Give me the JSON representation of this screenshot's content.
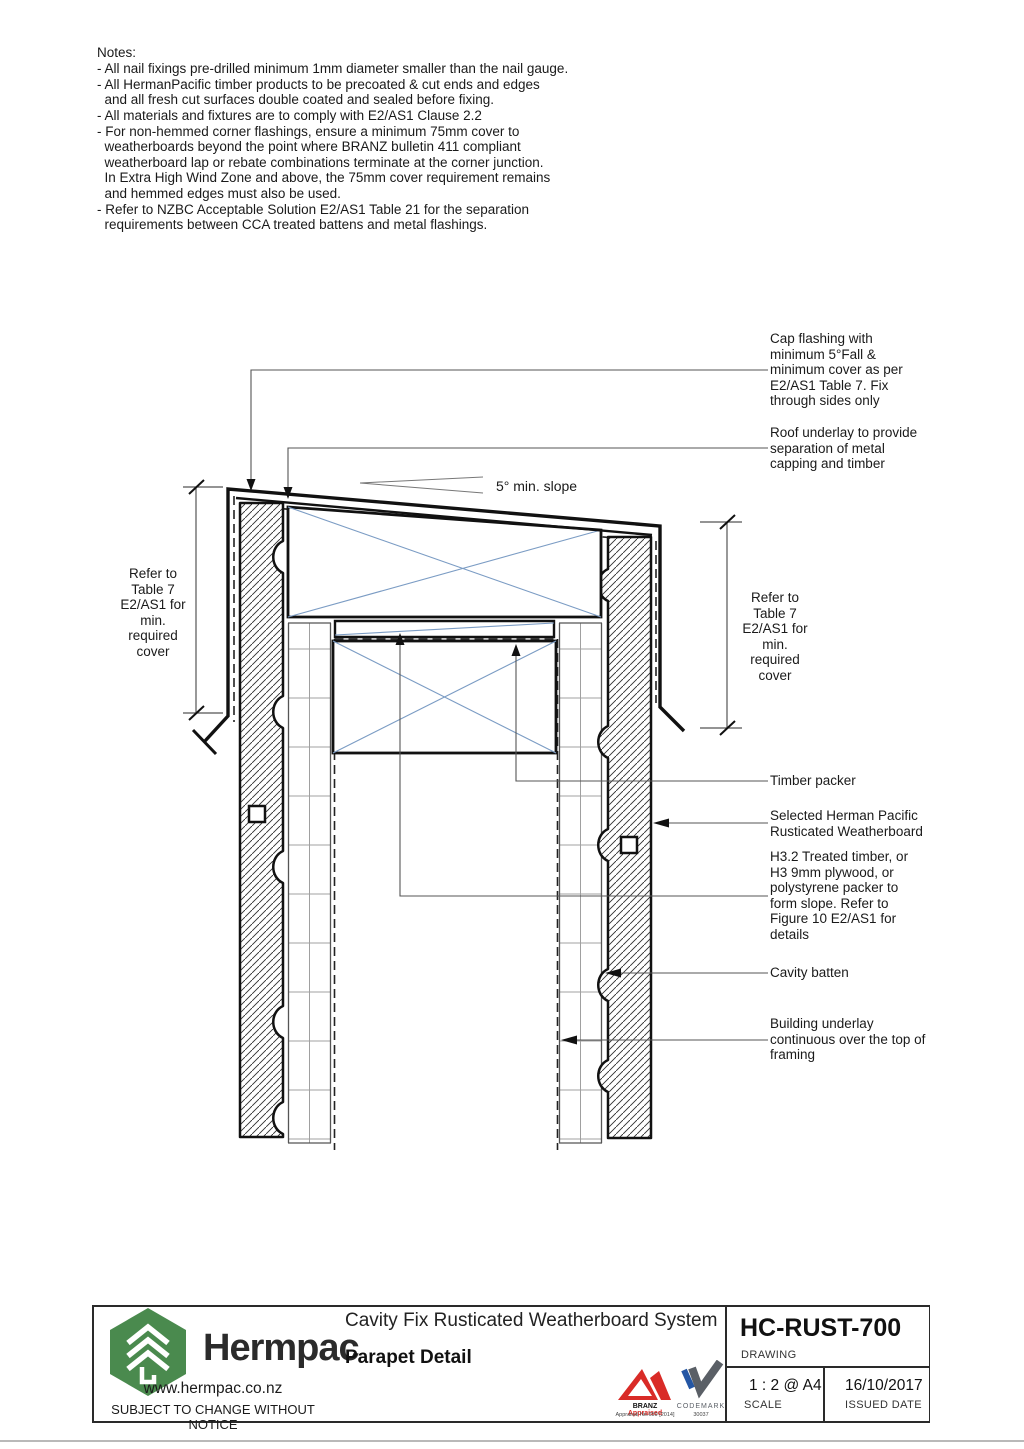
{
  "notes": {
    "title": "Notes:",
    "lines": [
      "- All nail fixings pre-drilled minimum 1mm diameter smaller than the nail gauge.",
      "- All HermanPacific timber products to be precoated & cut ends and edges",
      "  and all fresh cut surfaces double coated and sealed before fixing.",
      "- All materials and fixtures are to comply with E2/AS1 Clause 2.2",
      "- For non-hemmed corner flashings, ensure a minimum 75mm cover to",
      "  weatherboards beyond the point where BRANZ bulletin 411 compliant",
      "  weatherboard lap or rebate combinations terminate at the corner junction.",
      "  In Extra High Wind Zone and above, the 75mm cover requirement remains",
      "  and hemmed edges must also be used.",
      "- Refer to NZBC Acceptable Solution E2/AS1 Table 21 for the separation",
      "  requirements between CCA treated battens and metal flashings."
    ]
  },
  "annotations": {
    "slope": "5° min. slope",
    "cap_flashing": "Cap flashing with\nminimum 5°Fall &\nminimum cover as per\nE2/AS1 Table 7. Fix\nthrough sides only",
    "roof_underlay": "Roof underlay to provide\nseparation of metal\ncapping and timber",
    "dim_left": "Refer to\nTable 7\nE2/AS1 for\nmin.\nrequired\ncover",
    "dim_right": "Refer to\nTable 7\nE2/AS1 for\nmin.\nrequired\ncover",
    "timber_packer": "Timber packer",
    "weatherboard": "Selected Herman Pacific\nRusticated Weatherboard",
    "packer_slope": "H3.2 Treated timber, or\nH3 9mm plywood, or\npolystyrene packer to\nform slope. Refer to\nFigure 10 E2/AS1 for\ndetails",
    "cavity_batten": "Cavity batten",
    "building_underlay": "Building underlay\ncontinuous over the top of\nframing"
  },
  "title_block": {
    "brand": "Hermpac",
    "website": "www.hermpac.co.nz",
    "disclaimer": "SUBJECT TO CHANGE WITHOUT NOTICE",
    "system_title": "Cavity Fix Rusticated Weatherboard System",
    "drawing_title": "Parapet Detail",
    "drawing_number": "HC-RUST-700",
    "drawing_number_label": "DRAWING",
    "scale_value": "1 : 2 @ A4",
    "scale_label": "SCALE",
    "issued_date": "16/10/2017",
    "issued_date_label": "ISSUED DATE",
    "branz_word1": "BRANZ",
    "branz_word2": "Appraised",
    "branz_sub": "Appraisal No.659 [2014]",
    "codemark_name": "CODEMARK",
    "codemark_number": "30037"
  },
  "colors": {
    "logo_green": "#4a8a4e",
    "branz_red": "#d92b27",
    "codemark_blue": "#2456a4",
    "timber_cross_blue": "#7b9cc4",
    "line_black": "#111111"
  }
}
